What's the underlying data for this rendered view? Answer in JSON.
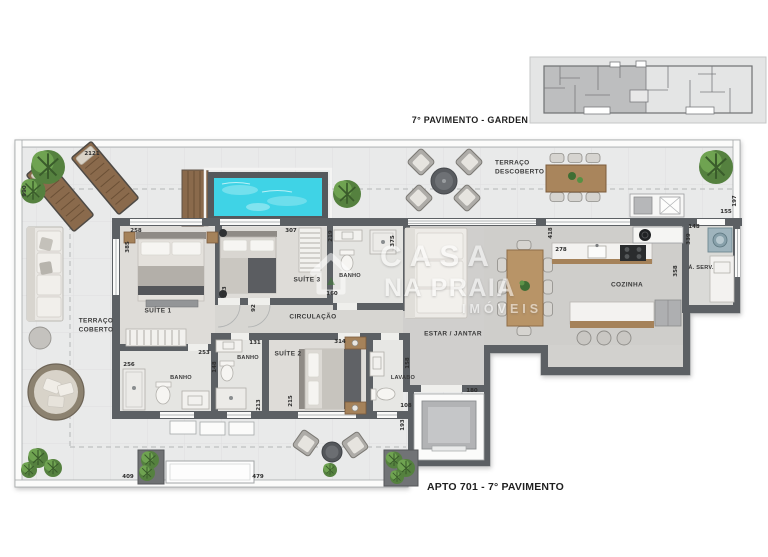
{
  "titles": {
    "key_plan": "7° PAVIMENTO - GARDEN",
    "unit": "APTO 701 - 7° PAVIMENTO"
  },
  "watermark": {
    "line1": "CASA",
    "line2": "NA PRAIA",
    "line3": "IMÓVEIS"
  },
  "palette": {
    "wall": "#5c6064",
    "terrace_floor": "#e9eaea",
    "interior_floor": "#dcdad6",
    "pool_water": "#3fd3e6",
    "wood": "#9a7751",
    "plant_green": "#55813f",
    "watermark_white": "#ffffff"
  },
  "plan": {
    "room_labels": [
      {
        "text": "TERRAÇO\nDESCOBERTO",
        "x": 495,
        "y": 168,
        "la": 1
      },
      {
        "text": "TERRAÇO\nCOBERTO",
        "x": 96,
        "y": 326
      },
      {
        "text": "SUÍTE 1",
        "x": 158,
        "y": 311
      },
      {
        "text": "SUÍTE 3",
        "x": 307,
        "y": 280
      },
      {
        "text": "SUÍTE 2",
        "x": 288,
        "y": 354
      },
      {
        "text": "BANHO",
        "x": 350,
        "y": 276,
        "small": 1
      },
      {
        "text": "BANHO",
        "x": 248,
        "y": 358,
        "small": 1
      },
      {
        "text": "BANHO",
        "x": 181,
        "y": 378,
        "small": 1
      },
      {
        "text": "LAVABO",
        "x": 403,
        "y": 378,
        "small": 1
      },
      {
        "text": "CIRCULAÇÃO",
        "x": 313,
        "y": 317
      },
      {
        "text": "ESTAR / JANTAR",
        "x": 453,
        "y": 334
      },
      {
        "text": "COZINHA",
        "x": 627,
        "y": 285
      },
      {
        "text": "Á. SERV.",
        "x": 701,
        "y": 268,
        "small": 1
      }
    ],
    "dimensions": [
      {
        "text": "2121",
        "x": 92,
        "y": 154
      },
      {
        "text": "990",
        "x": 25,
        "y": 191,
        "v": 1
      },
      {
        "text": "258",
        "x": 136,
        "y": 231
      },
      {
        "text": "385",
        "x": 128,
        "y": 247,
        "v": 1
      },
      {
        "text": "307",
        "x": 291,
        "y": 231
      },
      {
        "text": "219",
        "x": 331,
        "y": 236,
        "v": 1
      },
      {
        "text": "213",
        "x": 225,
        "y": 292,
        "v": 1
      },
      {
        "text": "92",
        "x": 254,
        "y": 308,
        "v": 1
      },
      {
        "text": "375",
        "x": 393,
        "y": 241,
        "v": 1
      },
      {
        "text": "160",
        "x": 332,
        "y": 294
      },
      {
        "text": "418",
        "x": 551,
        "y": 233,
        "v": 1
      },
      {
        "text": "278",
        "x": 561,
        "y": 250
      },
      {
        "text": "197",
        "x": 735,
        "y": 201,
        "v": 1
      },
      {
        "text": "155",
        "x": 726,
        "y": 212
      },
      {
        "text": "148",
        "x": 694,
        "y": 227
      },
      {
        "text": "339",
        "x": 689,
        "y": 239,
        "v": 1
      },
      {
        "text": "358",
        "x": 676,
        "y": 271,
        "v": 1
      },
      {
        "text": "256",
        "x": 129,
        "y": 365
      },
      {
        "text": "253",
        "x": 204,
        "y": 353
      },
      {
        "text": "148",
        "x": 215,
        "y": 367,
        "v": 1
      },
      {
        "text": "131",
        "x": 255,
        "y": 343
      },
      {
        "text": "213",
        "x": 259,
        "y": 405,
        "v": 1
      },
      {
        "text": "215",
        "x": 291,
        "y": 401,
        "v": 1
      },
      {
        "text": "314",
        "x": 340,
        "y": 342
      },
      {
        "text": "158",
        "x": 408,
        "y": 363,
        "v": 1
      },
      {
        "text": "108",
        "x": 406,
        "y": 406
      },
      {
        "text": "193",
        "x": 403,
        "y": 425,
        "v": 1
      },
      {
        "text": "180",
        "x": 472,
        "y": 391
      },
      {
        "text": "409",
        "x": 128,
        "y": 477
      },
      {
        "text": "479",
        "x": 258,
        "y": 477
      }
    ]
  }
}
